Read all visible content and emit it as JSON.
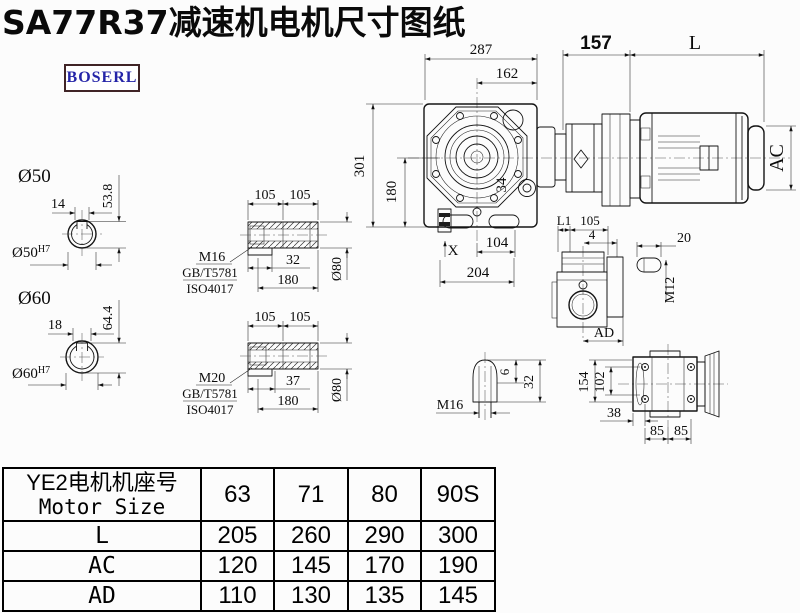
{
  "page": {
    "title": "SA77R37减速机电机尺寸图纸",
    "brand": "BOSERL"
  },
  "front": {
    "d287": "287",
    "d162": "162",
    "d157": "157",
    "dL": "L",
    "d301": "301",
    "d180": "180",
    "d34": "34",
    "dX": "X",
    "d104": "104",
    "d204": "204",
    "dAC": "AC"
  },
  "s50": {
    "t": "Ø50",
    "d14": "14",
    "d538": "53.8",
    "bore": "Ø50",
    "tol": "H7"
  },
  "s60": {
    "t": "Ø60",
    "d18": "18",
    "d644": "64.4",
    "bore": "Ø60",
    "tol": "H7"
  },
  "b1": {
    "d105a": "105",
    "d105b": "105",
    "thread": "M16",
    "std1": "GB/T5781",
    "std2": "ISO4017",
    "dk": "32",
    "dlen": "180",
    "dd": "Ø80"
  },
  "b2": {
    "d105a": "105",
    "d105b": "105",
    "thread": "M20",
    "std1": "GB/T5781",
    "std2": "ISO4017",
    "dk": "37",
    "dlen": "180",
    "dd": "Ø80"
  },
  "side": {
    "dL1": "L1",
    "d105": "105",
    "d4": "4",
    "dAD": "AD"
  },
  "key": {
    "d20": "20",
    "dM12": "M12"
  },
  "cone": {
    "thread": "M16",
    "d6": "6",
    "d32": "32"
  },
  "rear": {
    "d154": "154",
    "d102": "102",
    "d38": "38",
    "d85a": "85",
    "d85b": "85"
  },
  "table": {
    "header_cn": "YE2电机机座号",
    "header_en": "Motor Size",
    "sizes": [
      "63",
      "71",
      "80",
      "90S"
    ],
    "rows": [
      {
        "label": "L",
        "values": [
          "205",
          "260",
          "290",
          "300"
        ]
      },
      {
        "label": "AC",
        "values": [
          "120",
          "145",
          "170",
          "190"
        ]
      },
      {
        "label": "AD",
        "values": [
          "110",
          "130",
          "135",
          "145"
        ]
      }
    ]
  }
}
